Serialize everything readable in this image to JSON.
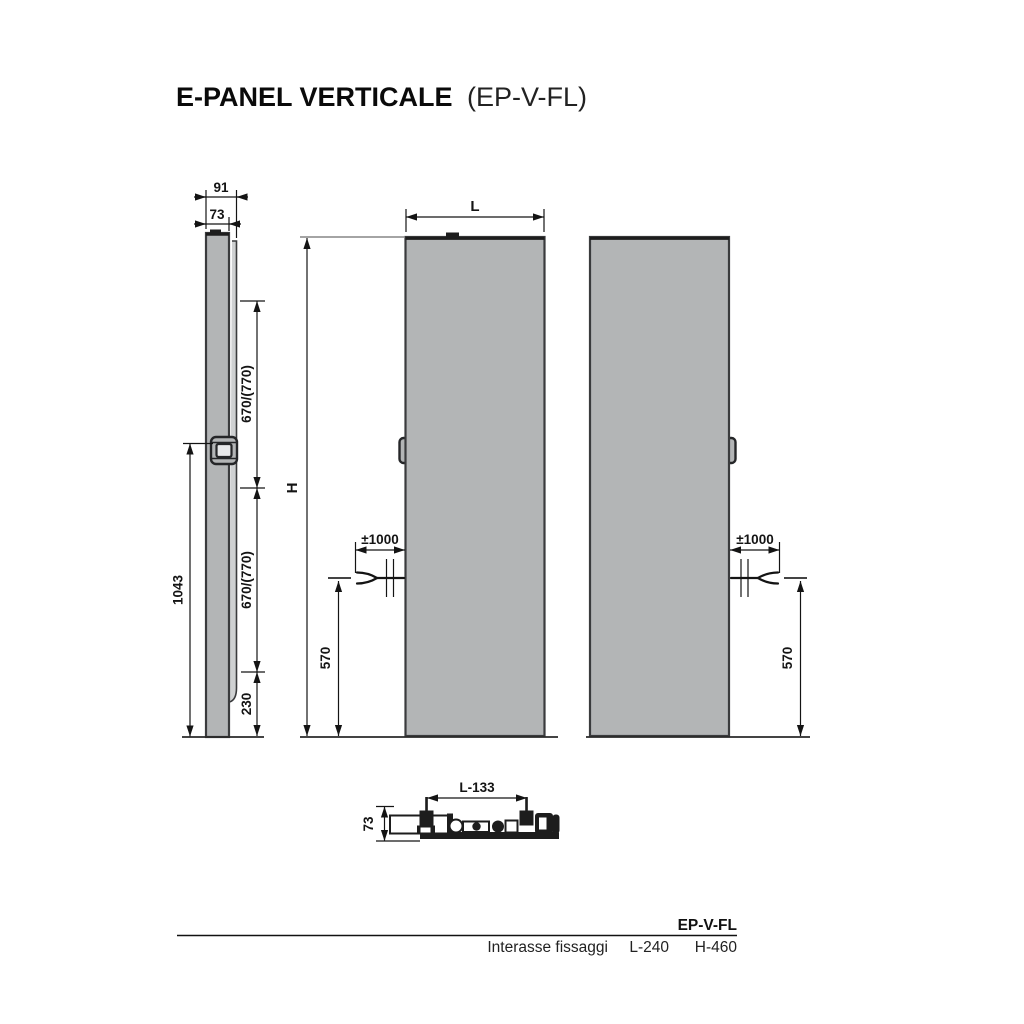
{
  "title": {
    "main": "E-PANEL VERTICALE",
    "code": "(EP-V-FL)"
  },
  "side_view": {
    "depth_total": "91",
    "depth_panel": "73",
    "span_upper": "670/(770)",
    "span_lower": "670/(770)",
    "bottom_offset": "230",
    "bracket_height": "1043"
  },
  "front_view": {
    "width_label": "L",
    "height_label": "H",
    "cable_length": "±1000",
    "connection_height": "570"
  },
  "right_view": {
    "cable_length": "±1000",
    "connection_height": "570"
  },
  "bottom_view": {
    "bracket_span": "L-133",
    "depth": "73"
  },
  "spec_table": {
    "model": "EP-V-FL",
    "row_label": "Interasse fissaggi",
    "l_spacing": "L-240",
    "h_spacing": "H-460"
  },
  "colors": {
    "panel_fill": "#b3b5b6",
    "panel_outline": "#3a3b3d",
    "dimension_line": "#141414",
    "background": "#ffffff"
  }
}
